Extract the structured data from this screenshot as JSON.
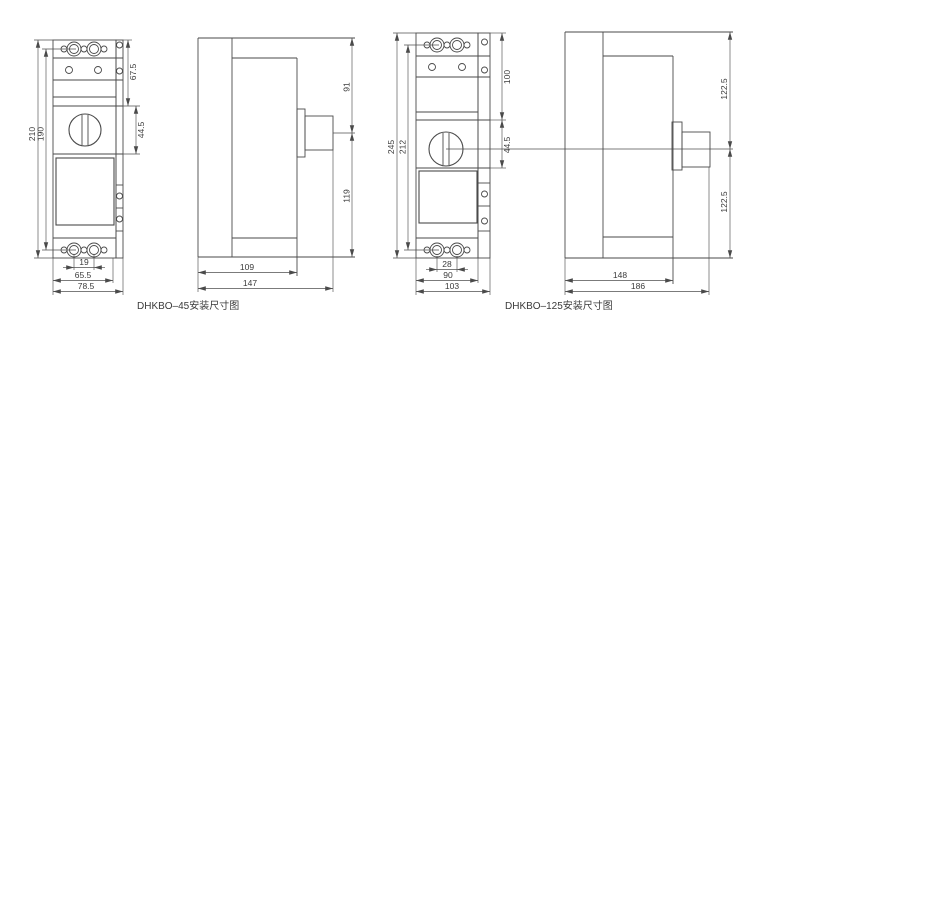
{
  "page": {
    "background": "#ffffff",
    "line_color": "#4a4a4a",
    "text_color": "#3a3a3a"
  },
  "figures": [
    {
      "caption": "DHKBO–45安装尺寸图",
      "front_dims": {
        "overall_height": "210",
        "mounting_height": "190",
        "top_to_handle": "67.5",
        "handle_section": "44.5",
        "terminal_pitch": "19",
        "body_width": "65.5",
        "overall_width": "78.5"
      },
      "side_dims": {
        "top_to_center": "91",
        "center_to_bottom": "119",
        "body_depth": "109",
        "overall_depth": "147"
      }
    },
    {
      "caption": "DHKBO–125安装尺寸图",
      "front_dims": {
        "overall_height": "245",
        "mounting_height": "212",
        "top_to_handle": "100",
        "handle_section": "44.5",
        "terminal_pitch": "28",
        "body_width": "90",
        "overall_width": "103"
      },
      "side_dims": {
        "top_to_center": "122.5",
        "center_to_bottom": "122.5",
        "body_depth": "148",
        "overall_depth": "186"
      }
    }
  ]
}
